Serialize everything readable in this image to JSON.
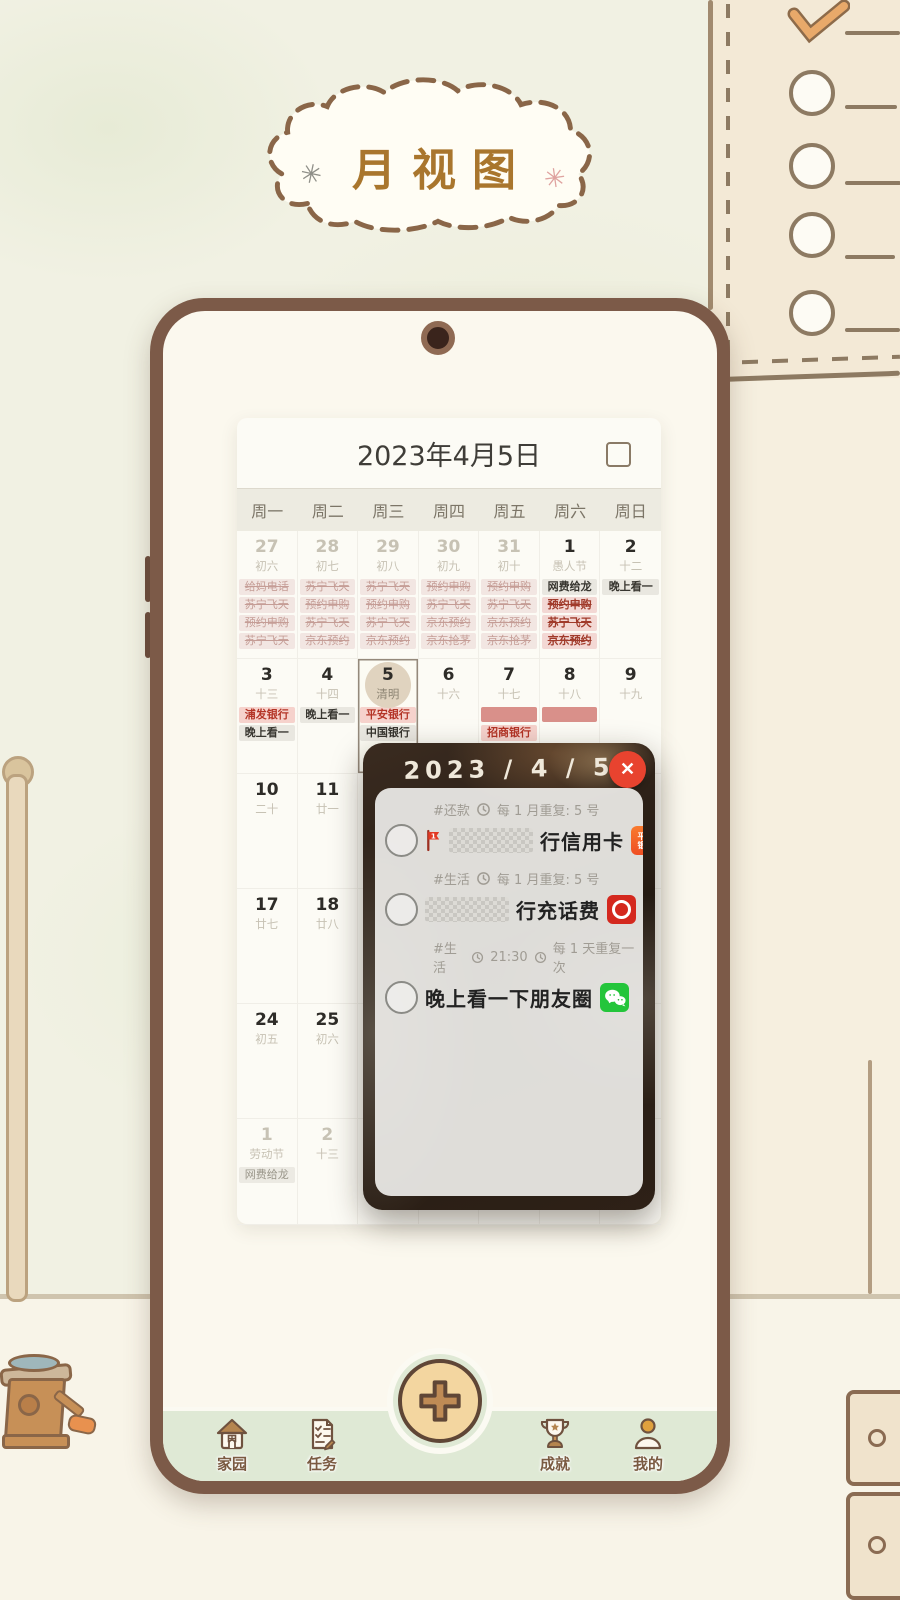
{
  "page_title": "月视图",
  "calendar": {
    "date_title": "2023年4月5日",
    "weekdays": [
      "周一",
      "周二",
      "周三",
      "周四",
      "周五",
      "周六",
      "周日"
    ],
    "weeks": [
      {
        "tall": true,
        "cells": [
          {
            "num": "27",
            "lunar": "初六",
            "cls": "dim",
            "events": [
              {
                "t": "给妈电话",
                "s": "past"
              },
              {
                "t": "苏宁飞天",
                "s": "past"
              },
              {
                "t": "预约申购",
                "s": "past"
              },
              {
                "t": "苏宁飞天",
                "s": "past"
              }
            ]
          },
          {
            "num": "28",
            "lunar": "初七",
            "cls": "dim",
            "events": [
              {
                "t": "苏宁飞天",
                "s": "past"
              },
              {
                "t": "预约申购",
                "s": "past"
              },
              {
                "t": "苏宁飞天",
                "s": "past"
              },
              {
                "t": "京东预约",
                "s": "past"
              }
            ]
          },
          {
            "num": "29",
            "lunar": "初八",
            "cls": "dim",
            "events": [
              {
                "t": "苏宁飞天",
                "s": "past"
              },
              {
                "t": "预约申购",
                "s": "past"
              },
              {
                "t": "苏宁飞天",
                "s": "past"
              },
              {
                "t": "京东预约",
                "s": "past"
              }
            ]
          },
          {
            "num": "30",
            "lunar": "初九",
            "cls": "dim",
            "events": [
              {
                "t": "预约申购",
                "s": "past"
              },
              {
                "t": "苏宁飞天",
                "s": "past"
              },
              {
                "t": "京东预约",
                "s": "past"
              },
              {
                "t": "京东抢茅",
                "s": "past"
              }
            ]
          },
          {
            "num": "31",
            "lunar": "初十",
            "cls": "dim",
            "events": [
              {
                "t": "预约申购",
                "s": "past"
              },
              {
                "t": "苏宁飞天",
                "s": "past"
              },
              {
                "t": "京东预约",
                "s": "past"
              },
              {
                "t": "京东抢茅",
                "s": "past"
              }
            ]
          },
          {
            "num": "1",
            "lunar": "愚人节",
            "cls": "",
            "events": [
              {
                "t": "网费给龙",
                "s": "gray"
              },
              {
                "t": "预约申购",
                "s": "done"
              },
              {
                "t": "苏宁飞天",
                "s": "done"
              },
              {
                "t": "京东预约",
                "s": "done"
              }
            ]
          },
          {
            "num": "2",
            "lunar": "十二",
            "cls": "",
            "events": [
              {
                "t": "晚上看一",
                "s": "gray"
              }
            ]
          }
        ]
      },
      {
        "cells": [
          {
            "num": "3",
            "lunar": "十三",
            "cls": "",
            "events": [
              {
                "t": "浦发银行",
                "s": "bank"
              },
              {
                "t": "晚上看一",
                "s": "gray"
              }
            ]
          },
          {
            "num": "4",
            "lunar": "十四",
            "cls": "",
            "events": [
              {
                "t": "晚上看一",
                "s": "gray"
              }
            ]
          },
          {
            "num": "5",
            "lunar": "清明",
            "cls": "sel",
            "events": [
              {
                "t": "平安银行",
                "s": "bank"
              },
              {
                "t": "中国银行",
                "s": "gray"
              }
            ]
          },
          {
            "num": "6",
            "lunar": "十六",
            "cls": "",
            "events": []
          },
          {
            "num": "7",
            "lunar": "十七",
            "cls": "",
            "events": [
              {
                "t": "",
                "s": "redact"
              },
              {
                "t": "招商银行",
                "s": "bank"
              }
            ]
          },
          {
            "num": "8",
            "lunar": "十八",
            "cls": "",
            "events": [
              {
                "t": "",
                "s": "redact"
              }
            ]
          },
          {
            "num": "9",
            "lunar": "十九",
            "cls": "",
            "events": []
          }
        ]
      },
      {
        "cells": [
          {
            "num": "10",
            "lunar": "二十",
            "cls": "",
            "events": []
          },
          {
            "num": "11",
            "lunar": "廿一",
            "cls": "",
            "events": []
          },
          {},
          {},
          {},
          {},
          {}
        ]
      },
      {
        "cells": [
          {
            "num": "17",
            "lunar": "廿七",
            "cls": "",
            "events": []
          },
          {
            "num": "18",
            "lunar": "廿八",
            "cls": "",
            "events": []
          },
          {},
          {},
          {},
          {},
          {}
        ]
      },
      {
        "cells": [
          {
            "num": "24",
            "lunar": "初五",
            "cls": "",
            "events": []
          },
          {
            "num": "25",
            "lunar": "初六",
            "cls": "",
            "events": []
          },
          {},
          {},
          {},
          {},
          {}
        ]
      },
      {
        "cells": [
          {
            "num": "1",
            "lunar": "劳动节",
            "cls": "dim",
            "events": [
              {
                "t": "网费给龙",
                "s": "graydim"
              }
            ]
          },
          {
            "num": "2",
            "lunar": "十三",
            "cls": "dim",
            "events": []
          },
          {},
          {},
          {},
          {},
          {}
        ]
      }
    ]
  },
  "popup": {
    "date_title": "2023 / 4 / 5",
    "close_glyph": "✕",
    "tasks": [
      {
        "tag": "#还款",
        "time": "",
        "repeat": "每 1 月重复: 5 号",
        "flag": "1",
        "redacted": true,
        "title": "行信用卡",
        "badge": "pingan",
        "badge_label": "平安银行"
      },
      {
        "tag": "#生活",
        "time": "",
        "repeat": "每 1 月重复: 5 号",
        "flag": "",
        "redacted": true,
        "title": "行充话费",
        "badge": "boc",
        "badge_label": ""
      },
      {
        "tag": "#生活",
        "time": "21:30",
        "repeat": "每 1 天重复一次",
        "flag": "",
        "redacted": false,
        "title": "晚上看一下朋友圈",
        "badge": "wechat",
        "badge_label": ""
      }
    ]
  },
  "tabbar": {
    "items": [
      {
        "label": "家园",
        "icon": "home-icon"
      },
      {
        "label": "任务",
        "icon": "tasks-icon"
      },
      {
        "label": "成就",
        "icon": "trophy-icon"
      },
      {
        "label": "我的",
        "icon": "profile-icon"
      }
    ]
  }
}
